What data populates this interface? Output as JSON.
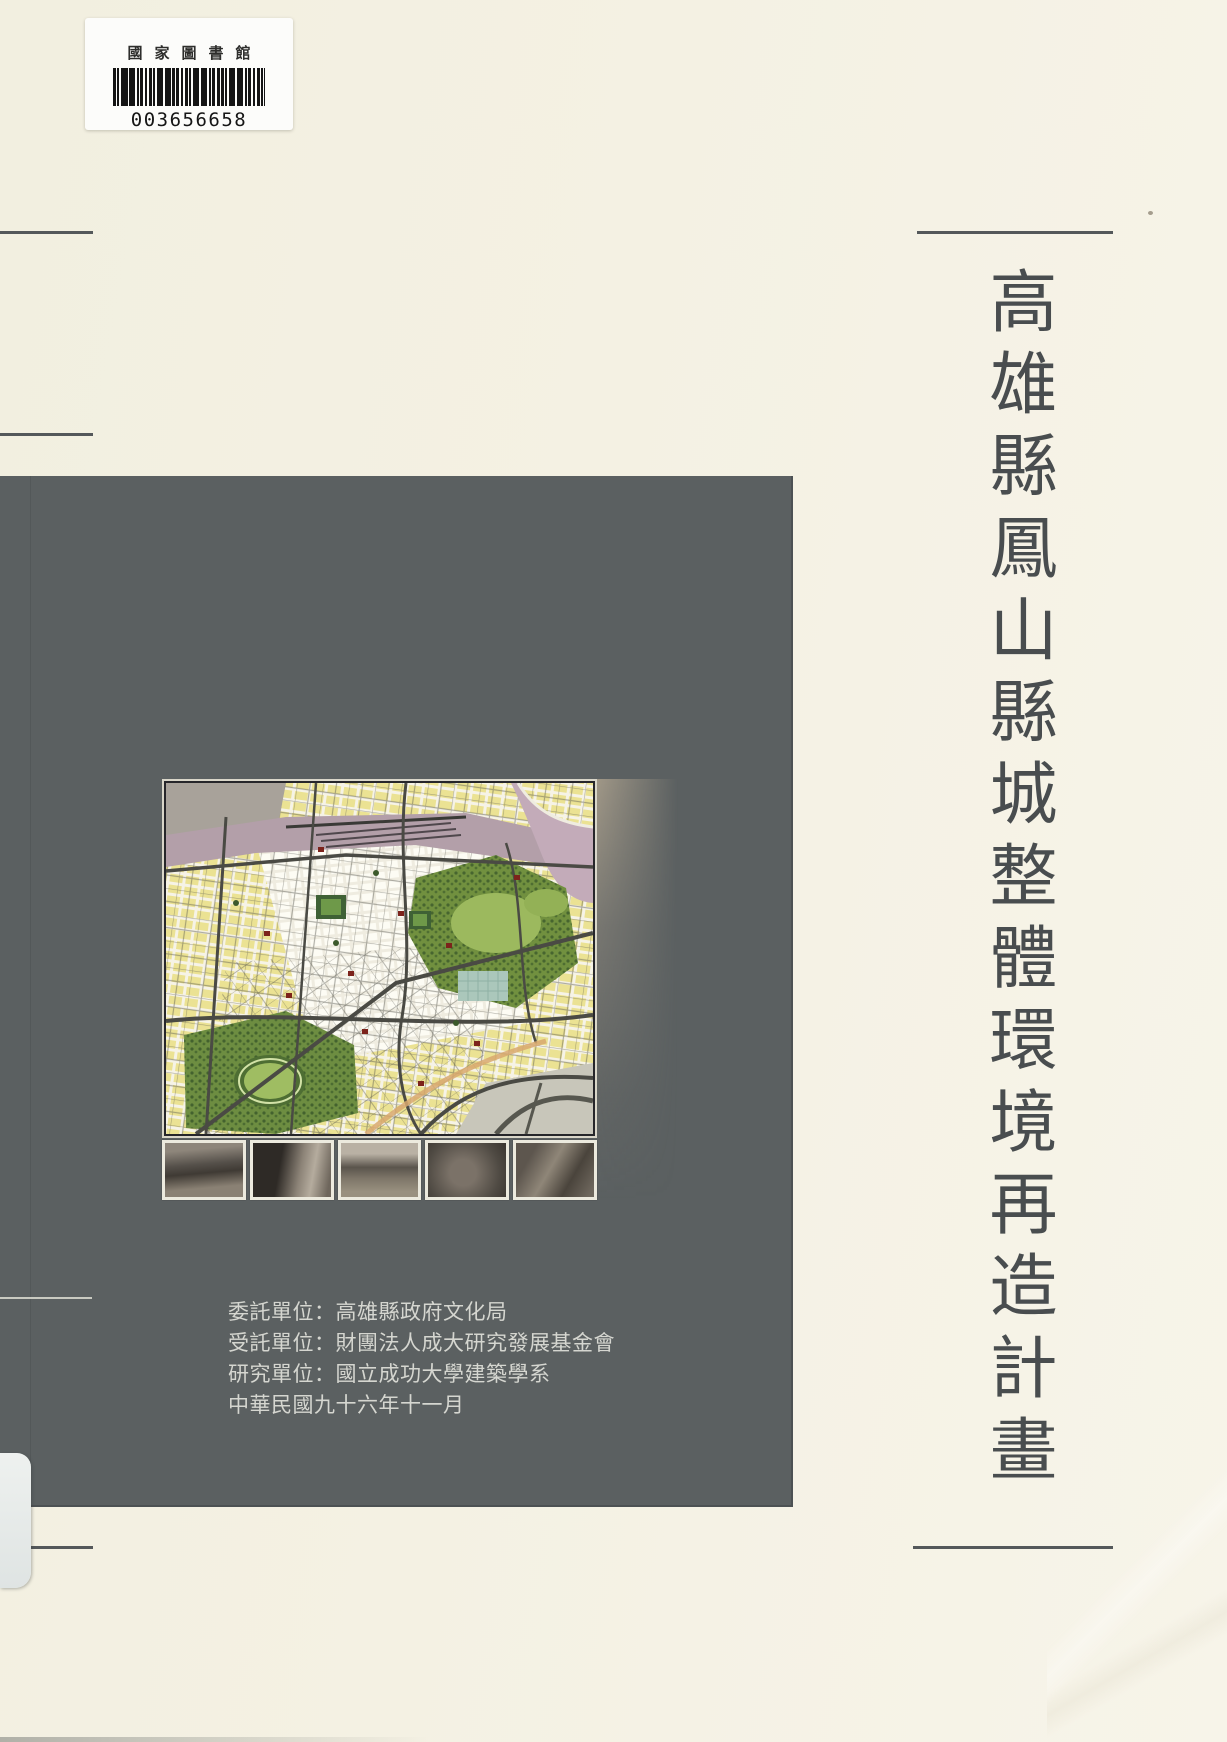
{
  "library_label": {
    "institution": "國家圖書館",
    "barcode_number": "003656658"
  },
  "cover": {
    "title": "高雄縣鳳山縣城整體環境再造計畫",
    "credits": [
      "委託單位：高雄縣政府文化局",
      "受託單位：財團法人成大研究發展基金會",
      "研究單位：國立成功大學建築學系",
      "中華民國九十六年十一月"
    ]
  },
  "map": {
    "photo_count": 5
  },
  "colors": {
    "page_background": "#f4f1e3",
    "panel": "#5b6061",
    "title_text": "#494d4f",
    "credits_text": "#d5d6d0",
    "rule_lines": "#54585a",
    "map_block_yellow": "#ebe293",
    "map_park_green": "#71903f",
    "map_rail_pink": "#b39fa9",
    "map_road_gray": "#4a4a44",
    "map_accent_red": "#7c231b"
  }
}
